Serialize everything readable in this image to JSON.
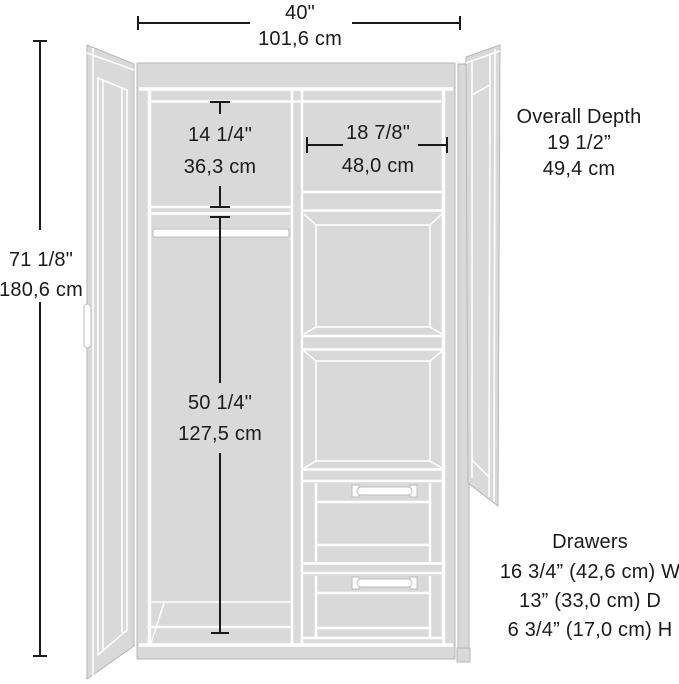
{
  "colors": {
    "panel_gray": "#d9d9d9",
    "edge_line_white": "#ffffff",
    "outline_gray": "#b7b7b7",
    "ink": "#1a1a1a",
    "background": "#ffffff"
  },
  "overall": {
    "width_in": "40\"",
    "width_cm": "101,6 cm",
    "height_in": "71 1/8\"",
    "height_cm": "180,6 cm",
    "depth_label": "Overall Depth",
    "depth_in": "19 1/2”",
    "depth_cm": "49,4 cm"
  },
  "interior": {
    "upper_left_height_in": "14 1/4\"",
    "upper_left_height_cm": "36,3 cm",
    "upper_right_width_in": "18 7/8\"",
    "upper_right_width_cm": "48,0 cm",
    "lower_left_height_in": "50 1/4\"",
    "lower_left_height_cm": "127,5 cm"
  },
  "drawers": {
    "label": "Drawers",
    "width": "16 3/4” (42,6 cm) W",
    "depth": "13” (33,0 cm) D",
    "height": "6 3/4” (17,0 cm) H"
  }
}
